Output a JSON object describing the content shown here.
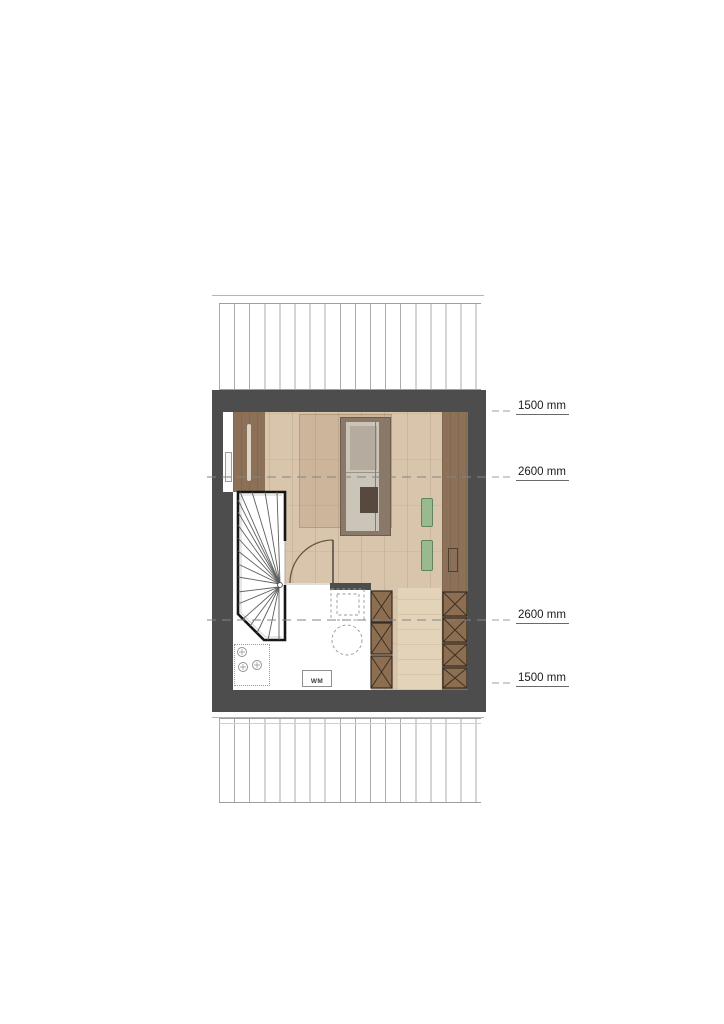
{
  "plan": {
    "type": "attic floor plan",
    "washing_machine_label": "WM",
    "dimension_labels": [
      {
        "text": "1500 mm"
      },
      {
        "text": "2600 mm"
      },
      {
        "text": "2600 mm"
      },
      {
        "text": "1500 mm"
      }
    ],
    "colors": {
      "wall": "#4d4d4d",
      "wood_floor": "#d9c5ab",
      "under_eaves_brown": "#8c7158",
      "storage_box_brown": "#8e6e51",
      "cushion_green": "#99ba8f"
    }
  }
}
